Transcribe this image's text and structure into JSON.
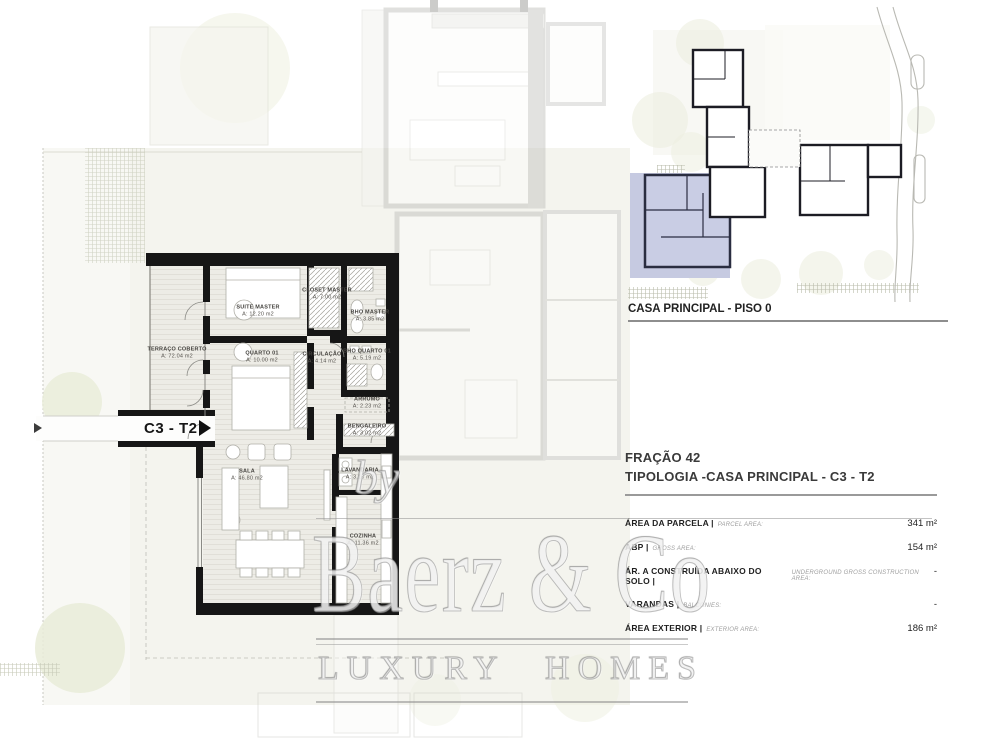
{
  "colors": {
    "unit_wall": "#1a1a1a",
    "site_highlight": "#c6cae1",
    "site_wall": "#2a2d40"
  },
  "unit_label": {
    "text": "C3 - T2"
  },
  "site_plan": {
    "caption": "CASA PRINCIPAL - PISO 0"
  },
  "floor_plan": {
    "rooms": [
      {
        "name": "SUITE MASTER",
        "area": "A: 12.20 m2"
      },
      {
        "name": "CLOSET MASTER",
        "area": "A: 7.00 m2"
      },
      {
        "name": "BHO MASTER",
        "area": "A: 3.85 m2"
      },
      {
        "name": "TERRAÇO COBERTO",
        "area": "A: 72.04 m2"
      },
      {
        "name": "QUARTO 01",
        "area": "A: 10.00 m2"
      },
      {
        "name": "CIRCULAÇÃO",
        "area": "A: 4.14 m2"
      },
      {
        "name": "BHO QUARTO 01",
        "area": "A: 5.19 m2"
      },
      {
        "name": "ARRUMO",
        "area": "A: 2.23 m2"
      },
      {
        "name": "BENGALEIRO",
        "area": "A: 3.02 m2"
      },
      {
        "name": "SALA",
        "area": "A: 46.80 m2"
      },
      {
        "name": "LAVANDARIA",
        "area": "A: 3.10 m2"
      },
      {
        "name": "COZINHA",
        "area": "A: 11.36 m2"
      }
    ]
  },
  "details": {
    "fraction": "FRAÇÃO 42",
    "typology": "TIPOLOGIA -CASA PRINCIPAL - C3 - T2",
    "rows": [
      {
        "label": "ÁREA DA PARCELA |",
        "sublabel": "PARCEL AREA:",
        "value": "341 m²"
      },
      {
        "label": "ABP |",
        "sublabel": "GROSS AREA:",
        "value": "154 m²"
      },
      {
        "label": "ÁR. A CONSTRUÍDA ABAIXO DO SOLO |",
        "sublabel": "UNDERGROUND GROSS CONSTRUCTION AREA:",
        "value": "-"
      },
      {
        "label": "VARANDAS |",
        "sublabel": "BALCONIES:",
        "value": "-"
      },
      {
        "label": "ÁREA EXTERIOR |",
        "sublabel": "EXTERIOR AREA:",
        "value": "186 m²"
      }
    ]
  },
  "watermark": {
    "by": "by",
    "brand": "Baerz & Co",
    "tagline": "LUXURY HOMES"
  }
}
